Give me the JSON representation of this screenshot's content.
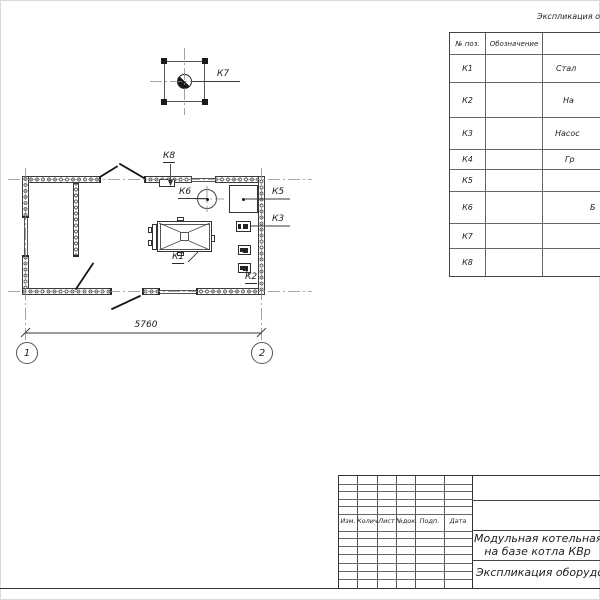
{
  "equip_table": {
    "title": "Экспликация оборудования",
    "col_pos": "№ поз.",
    "col_designation": "Обозначение",
    "rows": [
      {
        "pos": "К1",
        "name_fragment": "Стал"
      },
      {
        "pos": "К2",
        "name_fragment": "На"
      },
      {
        "pos": "К3",
        "name_fragment": "Насос"
      },
      {
        "pos": "К4",
        "name_fragment": "Гр"
      },
      {
        "pos": "К5",
        "name_fragment": ""
      },
      {
        "pos": "К6",
        "name_fragment": "Б"
      },
      {
        "pos": "К7",
        "name_fragment": ""
      },
      {
        "pos": "К8",
        "name_fragment": ""
      }
    ]
  },
  "plan": {
    "labels": {
      "k1": "К1",
      "k2": "К2",
      "k3": "К3",
      "k5": "К5",
      "k6": "К6",
      "k7": "К7",
      "k8": "К8"
    },
    "dimension_width": "5760",
    "axes": [
      "1",
      "2"
    ]
  },
  "title_block": {
    "header_cols": [
      "Изм.",
      "Колич",
      "Лист",
      "№док.",
      "Подп.",
      "Дата"
    ],
    "project_title_line1": "Модульная котельная",
    "project_title_line2": "на базе котла КВр",
    "sheet_title": "Экспликация оборудования"
  }
}
